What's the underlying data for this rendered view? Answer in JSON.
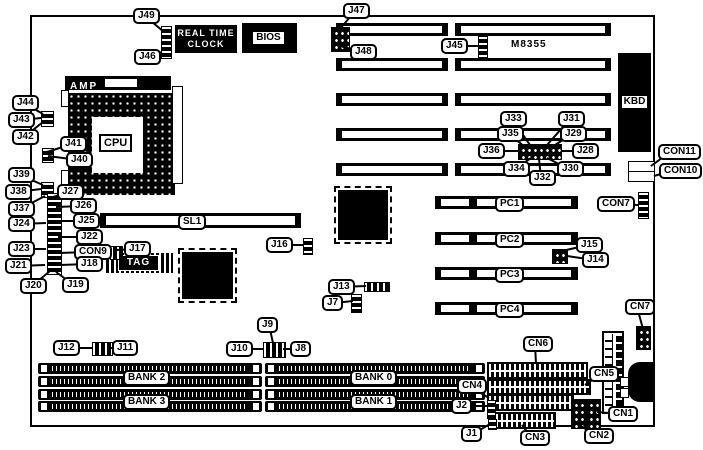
{
  "texts": {
    "rtc_line1": "REAL TIME",
    "rtc_line2": "CLOCK",
    "bios": "BIOS",
    "amp": "AMP",
    "cpu": "CPU",
    "kbd": "KBD",
    "tag": "TAG",
    "chip": "M8355"
  },
  "colors": {
    "ink": "#000000",
    "paper": "#ffffff"
  },
  "board": {
    "x": 30,
    "y": 15,
    "w": 621,
    "h": 408
  },
  "isa_slots": {
    "rows": [
      23,
      58,
      93,
      128,
      163
    ],
    "h": 13,
    "segments": [
      {
        "x": 336,
        "w": 112
      },
      {
        "x": 455,
        "w": 156
      }
    ]
  },
  "sl1_slot": {
    "x": 100,
    "y": 213,
    "w": 201,
    "h": 15
  },
  "pci_slots": {
    "x": 435,
    "w": 143,
    "h": 13,
    "rows": [
      196,
      232,
      267,
      302
    ]
  },
  "simm_sockets": {
    "rows": [
      363,
      376,
      389,
      401
    ],
    "h": 11,
    "groups": [
      {
        "x": 38,
        "w": 224
      },
      {
        "x": 265,
        "w": 220
      }
    ]
  },
  "striped_connectors": [
    {
      "x": 487,
      "y": 362,
      "w": 97,
      "h": 13,
      "n": "cn6-connector"
    },
    {
      "x": 487,
      "y": 379,
      "w": 100,
      "h": 12,
      "n": "cn5-connector"
    },
    {
      "x": 487,
      "y": 394,
      "w": 83,
      "h": 13,
      "n": "cn4-connector"
    },
    {
      "x": 494,
      "y": 412,
      "w": 58,
      "h": 13,
      "n": "cn3-connector"
    }
  ],
  "pin_blocks": [
    {
      "x": 161,
      "y": 26,
      "w": 9,
      "h": 31,
      "p": "rv",
      "n": "j46-j49-header"
    },
    {
      "x": 331,
      "y": 27,
      "w": 17,
      "h": 23,
      "p": "grid",
      "n": "j47-j48-header"
    },
    {
      "x": 478,
      "y": 36,
      "w": 8,
      "h": 20,
      "p": "rv",
      "n": "j45-header"
    },
    {
      "x": 41,
      "y": 111,
      "w": 11,
      "h": 14,
      "p": "rv",
      "n": "j42-j43-j44-header"
    },
    {
      "x": 42,
      "y": 148,
      "w": 10,
      "h": 13,
      "p": "rv",
      "n": "j40-j41-header"
    },
    {
      "x": 41,
      "y": 182,
      "w": 11,
      "h": 14,
      "p": "rv",
      "n": "j37-j38-j39-header"
    },
    {
      "x": 47,
      "y": 193,
      "w": 13,
      "h": 80,
      "p": "rv",
      "n": "left-jumper-strip"
    },
    {
      "x": 110,
      "y": 246,
      "w": 11,
      "h": 12,
      "p": "rh",
      "n": "j17-header"
    },
    {
      "x": 303,
      "y": 238,
      "w": 8,
      "h": 15,
      "p": "rv",
      "n": "j16-header"
    },
    {
      "x": 364,
      "y": 282,
      "w": 24,
      "h": 8,
      "p": "rh",
      "n": "j13-header"
    },
    {
      "x": 351,
      "y": 294,
      "w": 9,
      "h": 17,
      "p": "rv",
      "n": "j7-header"
    },
    {
      "x": 638,
      "y": 192,
      "w": 9,
      "h": 25,
      "p": "rv",
      "n": "con7-header"
    },
    {
      "x": 552,
      "y": 249,
      "w": 14,
      "h": 13,
      "p": "grid",
      "n": "j14-j15-header"
    },
    {
      "x": 518,
      "y": 144,
      "w": 42,
      "h": 14,
      "p": "grid",
      "n": "j28-j36-jumper-cluster"
    },
    {
      "x": 92,
      "y": 342,
      "w": 19,
      "h": 12,
      "p": "rh",
      "n": "j11-j12-header"
    },
    {
      "x": 263,
      "y": 342,
      "w": 21,
      "h": 14,
      "p": "rh",
      "n": "j8-j9-j10-header"
    },
    {
      "x": 571,
      "y": 399,
      "w": 13,
      "h": 28,
      "p": "grid",
      "n": "cn2-header"
    },
    {
      "x": 586,
      "y": 399,
      "w": 13,
      "h": 28,
      "p": "grid",
      "n": "cn1-header"
    },
    {
      "x": 636,
      "y": 326,
      "w": 13,
      "h": 22,
      "p": "grid",
      "n": "cn7-header"
    },
    {
      "x": 487,
      "y": 400,
      "w": 7,
      "h": 17,
      "p": "rv",
      "n": "j2-header"
    },
    {
      "x": 488,
      "y": 419,
      "w": 7,
      "h": 9,
      "p": "rv",
      "n": "j1-header"
    }
  ],
  "white_parts": [
    {
      "x": 628,
      "y": 161,
      "w": 25,
      "h": 9,
      "n": "con11-connector"
    },
    {
      "x": 628,
      "y": 171,
      "w": 25,
      "h": 9,
      "n": "con10-connector"
    },
    {
      "x": 620,
      "y": 377,
      "w": 7,
      "h": 8,
      "n": "din-pad"
    },
    {
      "x": 620,
      "y": 388,
      "w": 7,
      "h": 8,
      "n": "din-pad"
    },
    {
      "x": 61,
      "y": 90,
      "w": 6,
      "h": 15,
      "n": "capacitor"
    },
    {
      "x": 61,
      "y": 170,
      "w": 6,
      "h": 15,
      "n": "capacitor"
    },
    {
      "x": 172,
      "y": 86,
      "w": 9,
      "h": 96,
      "n": "vertical-header"
    }
  ],
  "chips": [
    {
      "x": 338,
      "y": 190,
      "w": 50,
      "h": 50,
      "n": "qfp-chip"
    },
    {
      "x": 182,
      "y": 252,
      "w": 51,
      "h": 47,
      "n": "qfp-chip"
    }
  ],
  "labels": [
    {
      "t": "J49",
      "x": 133,
      "y": 8,
      "lx": 164,
      "ly": 32
    },
    {
      "t": "J46",
      "x": 134,
      "y": 49,
      "lx": 162,
      "ly": 52
    },
    {
      "t": "J47",
      "x": 343,
      "y": 3,
      "lx": 340,
      "ly": 29
    },
    {
      "t": "J48",
      "x": 350,
      "y": 44,
      "lx": 340,
      "ly": 46
    },
    {
      "t": "J45",
      "x": 441,
      "y": 38,
      "lx": 479,
      "ly": 46
    },
    {
      "t": "CON11",
      "x": 658,
      "y": 144,
      "lx": 651,
      "ly": 166
    },
    {
      "t": "CON10",
      "x": 659,
      "y": 163,
      "lx": 654,
      "ly": 176
    },
    {
      "t": "CON7",
      "x": 597,
      "y": 196,
      "lx": 638,
      "ly": 205
    },
    {
      "t": "J44",
      "x": 12,
      "y": 95,
      "lx": 43,
      "ly": 114
    },
    {
      "t": "J43",
      "x": 8,
      "y": 112,
      "lx": 41,
      "ly": 118
    },
    {
      "t": "J42",
      "x": 12,
      "y": 129,
      "lx": 43,
      "ly": 122
    },
    {
      "t": "J41",
      "x": 60,
      "y": 136,
      "lx": 47,
      "ly": 152
    },
    {
      "t": "J40",
      "x": 66,
      "y": 152,
      "lx": 48,
      "ly": 156
    },
    {
      "t": "J39",
      "x": 8,
      "y": 167,
      "lx": 43,
      "ly": 185
    },
    {
      "t": "J38",
      "x": 5,
      "y": 184,
      "lx": 41,
      "ly": 189
    },
    {
      "t": "J37",
      "x": 8,
      "y": 201,
      "lx": 45,
      "ly": 196
    },
    {
      "t": "J27",
      "x": 57,
      "y": 184,
      "lx": 50,
      "ly": 198
    },
    {
      "t": "J26",
      "x": 70,
      "y": 198,
      "lx": 56,
      "ly": 207
    },
    {
      "t": "J24",
      "x": 8,
      "y": 216,
      "lx": 46,
      "ly": 223
    },
    {
      "t": "J25",
      "x": 73,
      "y": 213,
      "lx": 58,
      "ly": 221
    },
    {
      "t": "J22",
      "x": 76,
      "y": 229,
      "lx": 58,
      "ly": 237
    },
    {
      "t": "J23",
      "x": 8,
      "y": 241,
      "lx": 46,
      "ly": 249
    },
    {
      "t": "CON9",
      "x": 74,
      "y": 244,
      "lx": 60,
      "ly": 253
    },
    {
      "t": "J17",
      "x": 124,
      "y": 241,
      "lx": 116,
      "ly": 250
    },
    {
      "t": "J21",
      "x": 5,
      "y": 258,
      "lx": 45,
      "ly": 265
    },
    {
      "t": "J18",
      "x": 76,
      "y": 256,
      "lx": 60,
      "ly": 265
    },
    {
      "t": "J20",
      "x": 20,
      "y": 278,
      "lx": 50,
      "ly": 271
    },
    {
      "t": "J19",
      "x": 62,
      "y": 277,
      "lx": 56,
      "ly": 272
    },
    {
      "t": "SL1",
      "x": 178,
      "y": 214
    },
    {
      "t": "J16",
      "x": 266,
      "y": 237,
      "lx": 304,
      "ly": 245
    },
    {
      "t": "J13",
      "x": 328,
      "y": 279,
      "lx": 366,
      "ly": 286
    },
    {
      "t": "J7",
      "x": 322,
      "y": 295,
      "lx": 353,
      "ly": 301
    },
    {
      "t": "J33",
      "x": 500,
      "y": 111,
      "lx": 530,
      "ly": 145
    },
    {
      "t": "J31",
      "x": 558,
      "y": 111,
      "lx": 547,
      "ly": 145
    },
    {
      "t": "J35",
      "x": 497,
      "y": 126,
      "lx": 525,
      "ly": 147
    },
    {
      "t": "J29",
      "x": 560,
      "y": 126,
      "lx": 552,
      "ly": 147
    },
    {
      "t": "J36",
      "x": 478,
      "y": 143,
      "lx": 518,
      "ly": 151
    },
    {
      "t": "J28",
      "x": 572,
      "y": 143,
      "lx": 561,
      "ly": 151
    },
    {
      "t": "J34",
      "x": 503,
      "y": 161,
      "lx": 531,
      "ly": 158
    },
    {
      "t": "J32",
      "x": 529,
      "y": 170,
      "lx": 539,
      "ly": 159
    },
    {
      "t": "J30",
      "x": 557,
      "y": 161,
      "lx": 547,
      "ly": 158
    },
    {
      "t": "PC1",
      "x": 495,
      "y": 196
    },
    {
      "t": "PC2",
      "x": 495,
      "y": 232
    },
    {
      "t": "PC3",
      "x": 495,
      "y": 267
    },
    {
      "t": "PC4",
      "x": 495,
      "y": 302
    },
    {
      "t": "J15",
      "x": 576,
      "y": 237,
      "lx": 562,
      "ly": 251
    },
    {
      "t": "J14",
      "x": 582,
      "y": 252,
      "lx": 567,
      "ly": 256
    },
    {
      "t": "J12",
      "x": 53,
      "y": 340,
      "lx": 93,
      "ly": 348
    },
    {
      "t": "J11",
      "x": 112,
      "y": 340,
      "lx": 110,
      "ly": 348
    },
    {
      "t": "J10",
      "x": 226,
      "y": 341,
      "lx": 264,
      "ly": 349
    },
    {
      "t": "J9",
      "x": 257,
      "y": 317,
      "lx": 273,
      "ly": 343
    },
    {
      "t": "J8",
      "x": 290,
      "y": 341,
      "lx": 283,
      "ly": 349
    },
    {
      "t": "BANK 2",
      "x": 123,
      "y": 370
    },
    {
      "t": "BANK 3",
      "x": 123,
      "y": 394
    },
    {
      "t": "BANK 0",
      "x": 350,
      "y": 370
    },
    {
      "t": "BANK 1",
      "x": 350,
      "y": 394
    },
    {
      "t": "CN6",
      "x": 523,
      "y": 336,
      "lx": 536,
      "ly": 364
    },
    {
      "t": "CN5",
      "x": 589,
      "y": 366,
      "lx": 585,
      "ly": 385
    },
    {
      "t": "CN4",
      "x": 457,
      "y": 378,
      "lx": 489,
      "ly": 398
    },
    {
      "t": "J2",
      "x": 451,
      "y": 398,
      "lx": 488,
      "ly": 406
    },
    {
      "t": "J1",
      "x": 461,
      "y": 426,
      "lx": 490,
      "ly": 424
    },
    {
      "t": "CN3",
      "x": 520,
      "y": 430,
      "lx": 522,
      "ly": 425
    },
    {
      "t": "CN2",
      "x": 584,
      "y": 428,
      "lx": 578,
      "ly": 424
    },
    {
      "t": "CN1",
      "x": 608,
      "y": 406,
      "lx": 597,
      "ly": 412
    },
    {
      "t": "CN7",
      "x": 625,
      "y": 299,
      "lx": 643,
      "ly": 329
    }
  ]
}
